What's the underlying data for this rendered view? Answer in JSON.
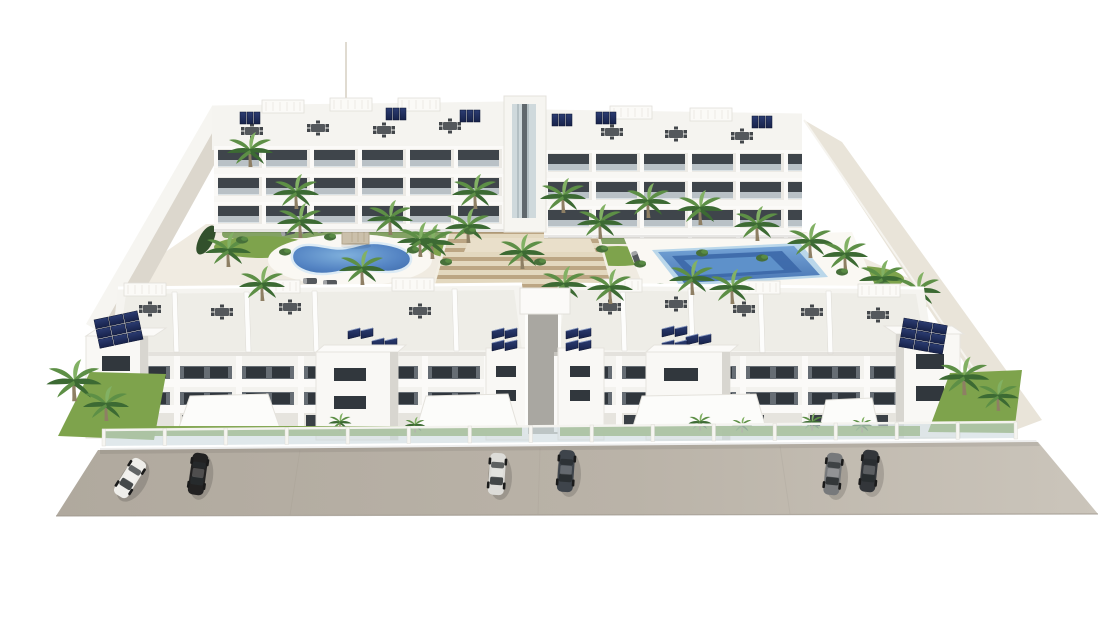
{
  "meta": {
    "title": "New-build residential complex aerial render",
    "type": "architectural-3d-render",
    "description": "Aerial 3D rendering of a white Mediterranean apartment complex: two rear apartment blocks and two front apartment blocks around a landscaped courtyard with a kidney-shaped pool, a rectangular pool, palm trees, a central amphitheater staircase, rooftop terraces with furniture and solar panels, and six cars parked on the street in front."
  },
  "palette": {
    "bg": "#ffffff",
    "wall_white": "#f6f5f1",
    "facade": "#f3f2ee",
    "side_shade": "#d8d6d0",
    "slab": "#fbfaf8",
    "roof_deck": "#f5f4f0",
    "roof_inner": "#ebe9e3",
    "window_dark": "#31373d",
    "glass": "#d9e2e7",
    "fence_glass": "#ccd8dd",
    "courtyard": "#f0ebe1",
    "walkway": "#dcd7cd",
    "right_wall": "#e9e4d9",
    "street_a": "#b0a99e",
    "street_b": "#cbc5bb",
    "lawn": "#7ea34c",
    "lawn_dark": "#5f8a3a",
    "bush": "#47703a",
    "palm_dark": "#3c6a33",
    "palm_mid": "#5d8f46",
    "palm_light": "#82b164",
    "trunk": "#8e7f64",
    "pool_rim": "#bad7ea",
    "pool_mid": "#6296cd",
    "pool_deep": "#3c68a8",
    "stairs_light": "#e3d8bf",
    "stairs_dark": "#bca684",
    "furniture": "#54585c",
    "furniture_dark": "#43474b",
    "solar_dark": "#17224a",
    "solar_mid": "#2b3c72",
    "edge_line": "#e2e0da"
  },
  "scene": {
    "buildings": [
      {
        "name": "rear-left-apartment-block",
        "floors": 3,
        "features": [
          "balconies with glass balustrades",
          "rooftop terraces",
          "outdoor furniture",
          "solar panels"
        ]
      },
      {
        "name": "rear-right-apartment-block",
        "floors": 3,
        "features": [
          "balconies with glass balustrades",
          "rooftop terraces",
          "outdoor furniture",
          "solar panels"
        ]
      },
      {
        "name": "front-left-apartment-block",
        "floors": 3,
        "features": [
          "window bands",
          "stair towers",
          "white awnings",
          "roof terraces with furniture",
          "solar panels"
        ]
      },
      {
        "name": "front-right-apartment-block",
        "floors": 3,
        "features": [
          "window bands",
          "stair towers",
          "white awnings",
          "roof terraces with furniture",
          "solar panels"
        ]
      },
      {
        "name": "central-lift-tower",
        "floors": 3,
        "features": [
          "glazed shaft"
        ]
      }
    ],
    "courtyard": {
      "pools": [
        {
          "name": "kidney-pool",
          "shape": "kidney",
          "water_color": "#5585c4"
        },
        {
          "name": "rectangular-pool",
          "shape": "rectangle",
          "water_color": "#6296cd",
          "deep_color": "#3c68a8"
        }
      ],
      "amphitheater_stairs": {
        "material": "wood-tone steps",
        "color": "#c9b28a"
      },
      "pergola": {
        "color": "#cbc0ab"
      },
      "sun_loungers": 9,
      "palm_trees": 30,
      "bushes": 14
    },
    "roof": {
      "furniture_sets": 12,
      "solar_arrays": 12,
      "pergola_boxes": 8
    },
    "street": {
      "surface": "asphalt-beige",
      "fence": "glass panels with white posts",
      "fence_posts": 16
    },
    "vehicles": [
      {
        "name": "white-sedan",
        "body_color": "#efeeea"
      },
      {
        "name": "black-sedan",
        "body_color": "#232222"
      },
      {
        "name": "silver-sedan",
        "body_color": "#dddcd8"
      },
      {
        "name": "graphite-suv",
        "body_color": "#3e444b"
      },
      {
        "name": "gray-suv",
        "body_color": "#77797b"
      },
      {
        "name": "black-silver-suv",
        "body_color": "#33363a"
      }
    ]
  }
}
